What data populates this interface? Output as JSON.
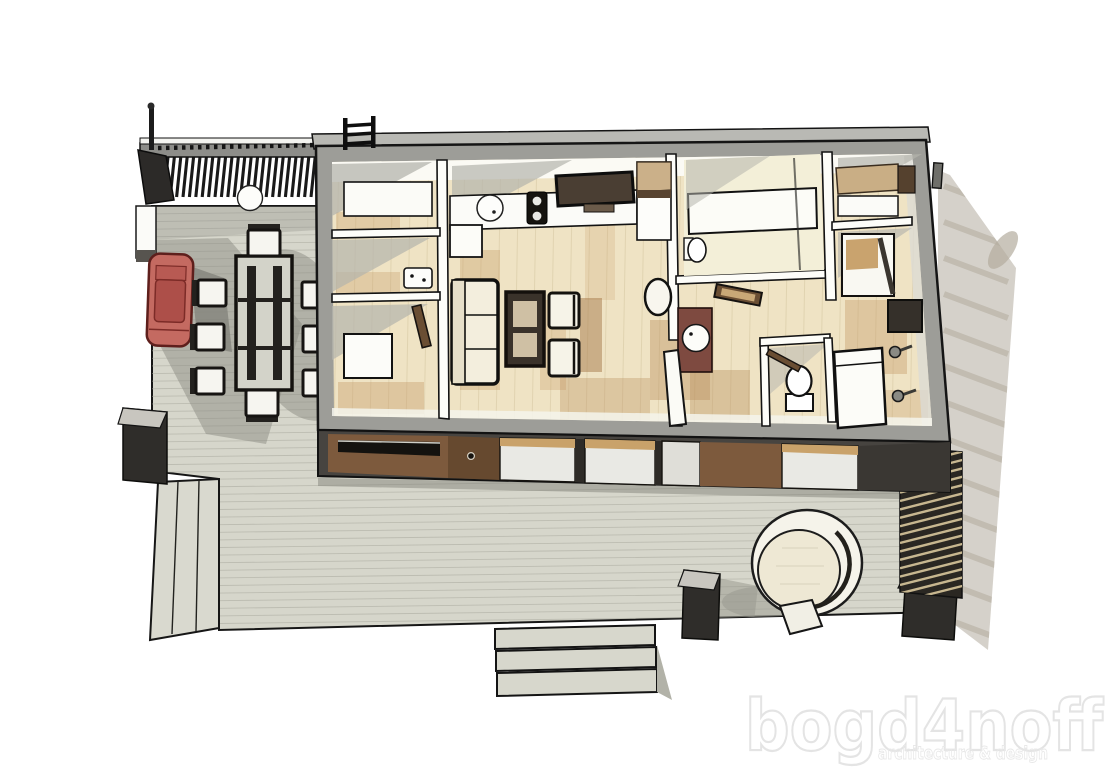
{
  "watermark": {
    "title": "bogd4noff",
    "subtitle": "architecture & design",
    "color": "#e4e4e4"
  },
  "scene": {
    "type": "3d-architectural-floor-plan",
    "view": "axonometric top-down cutaway render of a single-storey house with deck",
    "palette": {
      "background": "#ffffff",
      "deck": "#d6d6cb",
      "deck_plank_line": "#a8a89d",
      "shadow": "#8d8d85",
      "house_shadow": "#b3ac9e",
      "cut_wall_outer": "#9d9d98",
      "partition_wall": "#fdfdf9",
      "interior_floor": "#efe3c4",
      "floor_streak": "#c79a63",
      "facade_wood": "#7d5a3d",
      "facade_dark": "#3a3733",
      "pergola_slat": "#191919",
      "car_body": "#c46a61",
      "planter": "#2f2d2a",
      "hot_tub_ring": "#f5f3ea",
      "fence_gap": "#d9c79c"
    },
    "outdoor": {
      "pergola_carport": "slatted flat roof over patio, top-left, with post and roof light",
      "car": {
        "color_name": "red",
        "parked": "under carport, facing down"
      },
      "dining_set": {
        "table": 1,
        "chairs": 8
      },
      "white_edge_boxes": 2,
      "dark_planters": 3,
      "deck_steps_front_treads": 3,
      "deck_steps_left": 1,
      "privacy_screen": "diagonal slatted screen on right edge of deck",
      "hot_tub": "round tub sunken in deck, bottom right, with small step"
    },
    "house": {
      "roof_ladder": "top centre-left on rear parapet",
      "roof_vent_post": "top right corner",
      "rooms": [
        {
          "name": "storage-room",
          "furniture": [
            "white shelf unit"
          ]
        },
        {
          "name": "utility-room",
          "furniture": [
            "wall-mounted boiler panel"
          ]
        },
        {
          "name": "entry",
          "furniture": [
            "white cabinet",
            "open interior door"
          ]
        },
        {
          "name": "kitchen",
          "furniture": [
            "counter",
            "round sink",
            "cooktop",
            "dark wall panel",
            "tall cabinet"
          ]
        },
        {
          "name": "living-room",
          "furniture": [
            "sofa",
            "coffee table",
            "2 armchairs",
            "round lounge chair"
          ]
        },
        {
          "name": "shower-room",
          "furniture": [
            "bathtub",
            "glass screen",
            "toilet"
          ]
        },
        {
          "name": "bath-hall",
          "furniture": [
            "brown vanity",
            "round washbasin",
            "open white door"
          ]
        },
        {
          "name": "wc",
          "furniture": [
            "toilet"
          ]
        },
        {
          "name": "dressing",
          "furniture": [
            "open closet shelf",
            "dark cabinet"
          ]
        },
        {
          "name": "bedroom",
          "furniture": [
            "bed",
            "dark desk",
            "2 wall lamps"
          ]
        }
      ]
    }
  }
}
